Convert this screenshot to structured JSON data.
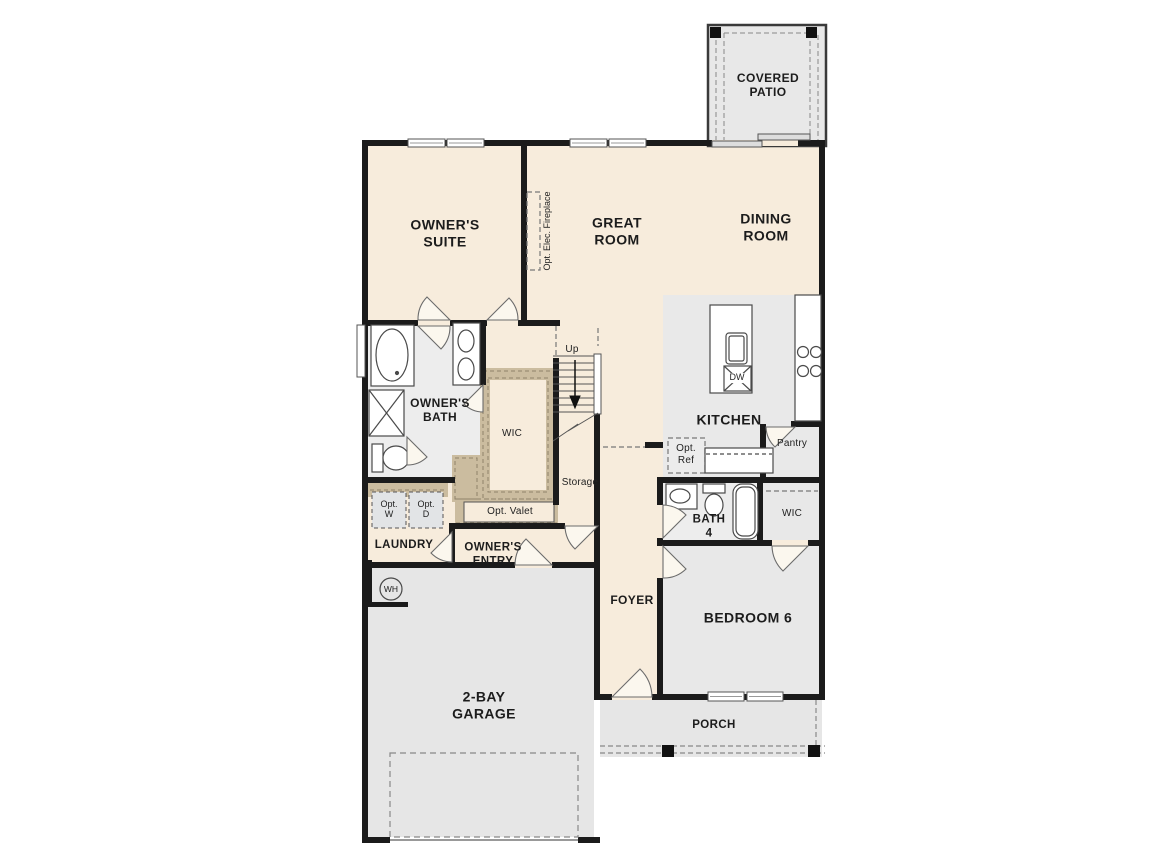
{
  "title": "First floor plan",
  "labels": {
    "covered_patio": "COVERED\nPATIO",
    "owners_suite": "OWNER'S\nSUITE",
    "great_room": "GREAT\nROOM",
    "dining_room": "DINING\nROOM",
    "opt_fireplace": "Opt. Elec. Fireplace",
    "kitchen": "KITCHEN",
    "dw": "DW",
    "pantry": "Pantry",
    "opt_ref": "Opt.\nRef",
    "owners_bath": "OWNER'S\nBATH",
    "wic_owners": "WIC",
    "up": "Up",
    "storage": "Storage",
    "opt_valet": "Opt. Valet",
    "opt_w": "Opt.\nW",
    "opt_d": "Opt.\nD",
    "laundry": "LAUNDRY",
    "owners_entry": "OWNER'S\nENTRY",
    "wh": "WH",
    "foyer": "FOYER",
    "bath4": "BATH\n4",
    "wic_bed6": "WIC",
    "bedroom6": "BEDROOM 6",
    "garage": "2-BAY\nGARAGE",
    "porch": "PORCH"
  },
  "colors": {
    "floor_cream": "#f7ecdc",
    "floor_gray": "#e8e8e8",
    "floor_light_gray": "#ededed",
    "garage_gray": "#e6e6e6",
    "wall": "#1b1b1b",
    "tan_band": "#cbbc9f",
    "tan_dash": "#8f8268",
    "fixture_stroke": "#4a4a4a",
    "dash_gray": "#777777"
  }
}
